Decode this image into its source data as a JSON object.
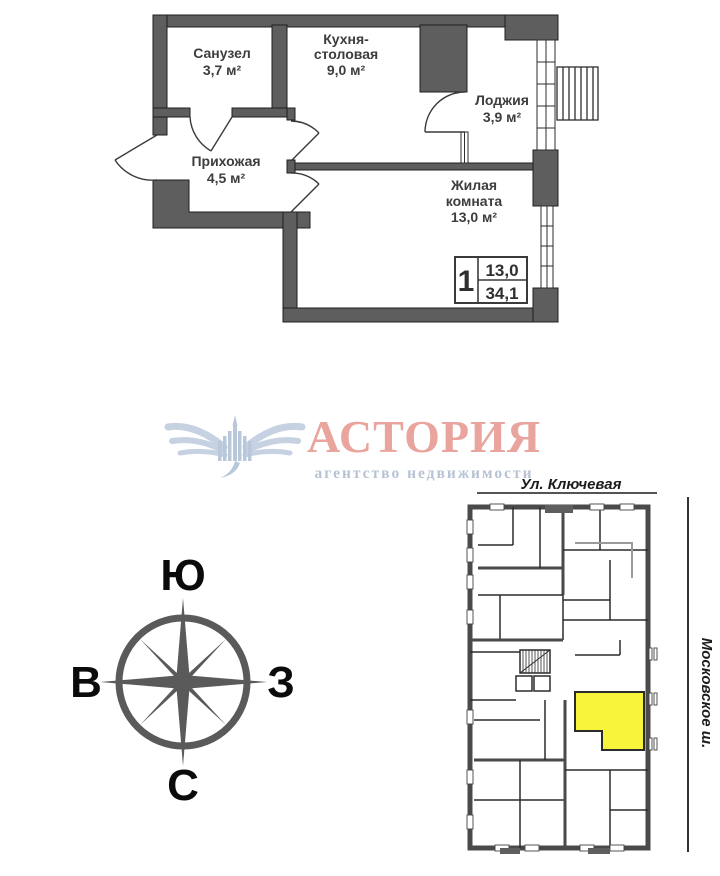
{
  "floor_plan": {
    "rooms": {
      "sanuzel": {
        "name": "Санузел",
        "area": "3,7 м²"
      },
      "kitchen": {
        "line1": "Кухня-",
        "line2": "столовая",
        "area": "9,0 м²"
      },
      "loggia": {
        "name": "Лоджия",
        "area": "3,9 м²"
      },
      "hallway": {
        "name": "Прихожая",
        "area": "4,5 м²"
      },
      "living": {
        "line1": "Жилая",
        "line2": "комната",
        "area": "13,0 м²"
      }
    },
    "info_box": {
      "rooms": "1",
      "living_area": "13,0",
      "total_area": "34,1"
    }
  },
  "logo": {
    "title": "АСТОРИЯ",
    "subtitle": "агентство недвижимости"
  },
  "compass": {
    "top": "Ю",
    "left": "В",
    "right": "З",
    "bottom": "С"
  },
  "site_plan": {
    "street_top": "Ул. Ключевая",
    "street_right": "Московское ш."
  },
  "colors": {
    "wall": "#5e5e5e",
    "label": "#3d3d3d",
    "logo_title": "#e9a49d",
    "logo_subtitle": "#b7c3d4",
    "logo_emblem": "#c6d2e2",
    "highlight": "#f8f43c"
  }
}
